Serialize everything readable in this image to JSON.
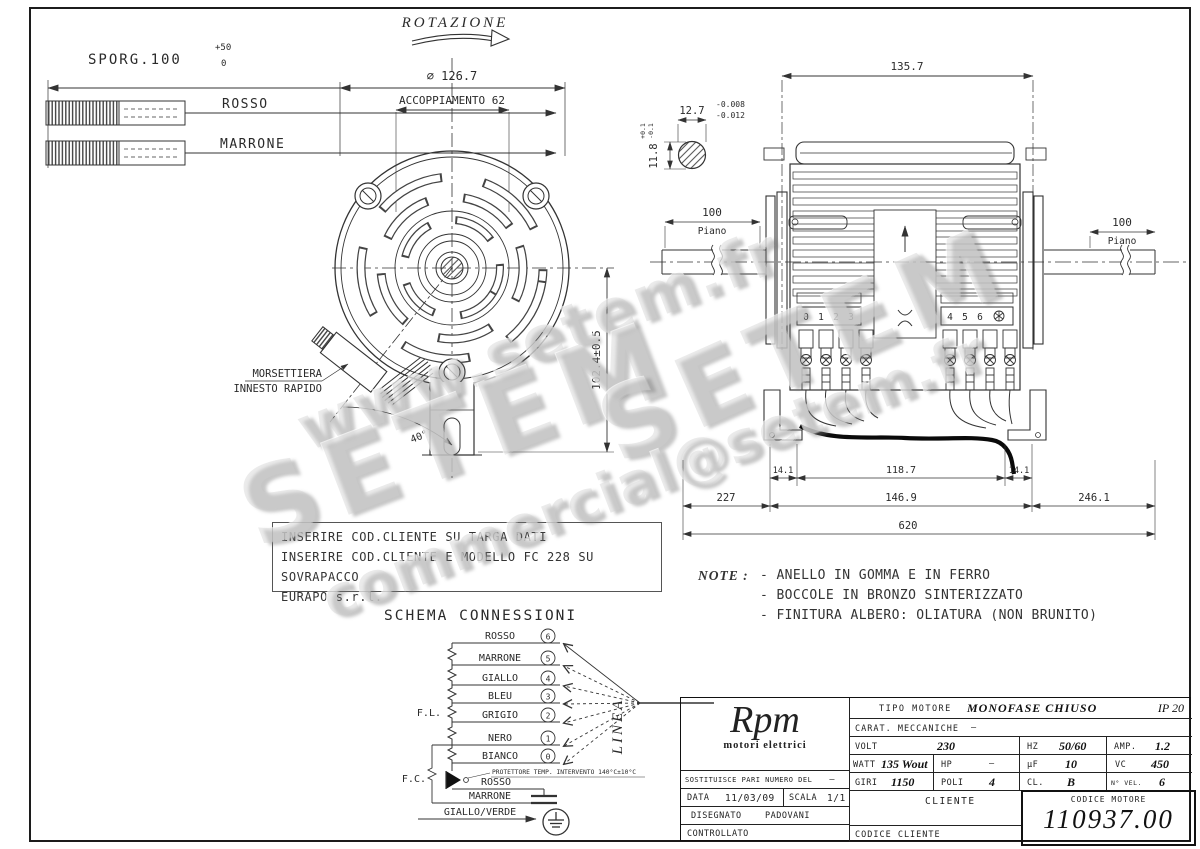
{
  "watermarks": {
    "url": "www.setem.fr",
    "brand": "SETEM",
    "email": "commercial@setem.fr"
  },
  "top_left": {
    "label": "SPORG.100",
    "tol_plus": "+50",
    "tol_zero": "0",
    "wire_top": "ROSSO",
    "wire_bottom": "MARRONE"
  },
  "rotation_label": "ROTAZIONE",
  "front_view": {
    "diameter": "⌀ 126.7",
    "coupling": "ACCOPPIAMENTO 62",
    "height_dim": "102.4±0.5",
    "angle": "40°",
    "morsettiera_line1": "MORSETTIERA",
    "morsettiera_line2": "INNESTO RAPIDO"
  },
  "shaft_detail": {
    "width": "12.7",
    "width_tol_upper": "-0.008",
    "width_tol_lower": "-0.012",
    "height": "11.8",
    "height_tol_upper": "+0.1",
    "height_tol_lower": "-0.1"
  },
  "side_view": {
    "length": "135.7",
    "flat_left_value": "100",
    "flat_left_label": "Piano",
    "flat_right_value": "100",
    "flat_right_label": "Piano",
    "terminals_left": [
      "0",
      "1",
      "2",
      "3"
    ],
    "terminals_right": [
      "4",
      "5",
      "6"
    ],
    "dims_feet": [
      "14.1",
      "118.7",
      "14.1"
    ],
    "dims_mid": [
      "227",
      "146.9",
      "246.1"
    ],
    "dim_overall": "620"
  },
  "client_note_lines": [
    "INSERIRE COD.CLIENTE SU TARGA DATI",
    "INSERIRE COD.CLIENTE E MODELLO FC 228 SU SOVRAPACCO",
    "EURAPO s.r.l."
  ],
  "notes": {
    "label": "NOTE :",
    "items": [
      "- ANELLO IN GOMMA E IN FERRO",
      "- BOCCOLE IN BRONZO SINTERIZZATO",
      "- FINITURA ALBERO: OLIATURA (NON BRUNITO)"
    ]
  },
  "schema": {
    "title": "SCHEMA CONNESSIONI",
    "wires": [
      {
        "label": "ROSSO",
        "num": "6"
      },
      {
        "label": "MARRONE",
        "num": "5"
      },
      {
        "label": "GIALLO",
        "num": "4"
      },
      {
        "label": "BLEU",
        "num": "3"
      },
      {
        "label": "GRIGIO",
        "num": "2"
      },
      {
        "label": "NERO",
        "num": "1"
      },
      {
        "label": "BIANCO",
        "num": "0"
      }
    ],
    "fl": "F.L.",
    "fc": "F.C.",
    "linea": "LINEA",
    "protector": "PROTETTORE TEMP. INTERVENTO 140°C±10°C",
    "cap_wire_top": "ROSSO",
    "cap_wire_bottom": "MARRONE",
    "earth_wire": "GIALLO/VERDE"
  },
  "title_block": {
    "logo": "Rpm",
    "logo_sub": "motori elettrici",
    "tipo_label": "TIPO MOTORE",
    "tipo_value": "MONOFASE CHIUSO",
    "ip": "IP 20",
    "carat_label": "CARAT. MECCANICHE",
    "carat_value": "—",
    "volt_label": "VOLT",
    "volt": "230",
    "hz_label": "HZ",
    "hz": "50/60",
    "amp_label": "AMP.",
    "amp": "1.2",
    "watt_label": "WATT",
    "watt": "135 Wout",
    "hp_label": "HP",
    "hp": "—",
    "uf_label": "µF",
    "uf": "10",
    "vc_label": "VC",
    "vc": "450",
    "giri_label": "GIRI",
    "giri": "1150",
    "poli_label": "POLI",
    "poli": "4",
    "cl_label": "CL.",
    "cl": "B",
    "nvel_label": "N° VEL.",
    "nvel": "6",
    "sost_label": "SOSTITUISCE PARI NUMERO DEL",
    "sost_value": "—",
    "data_label": "DATA",
    "data_value": "11/03/09",
    "scala_label": "SCALA",
    "scala_value": "1/1",
    "cliente_label": "CLIENTE",
    "disegnato_label": "DISEGNATO",
    "disegnato_value": "PADOVANI",
    "controllato_label": "CONTROLLATO",
    "codice_cliente_label": "CODICE CLIENTE",
    "codice_motore_label": "CODICE MOTORE",
    "codice_motore": "110937.00"
  }
}
